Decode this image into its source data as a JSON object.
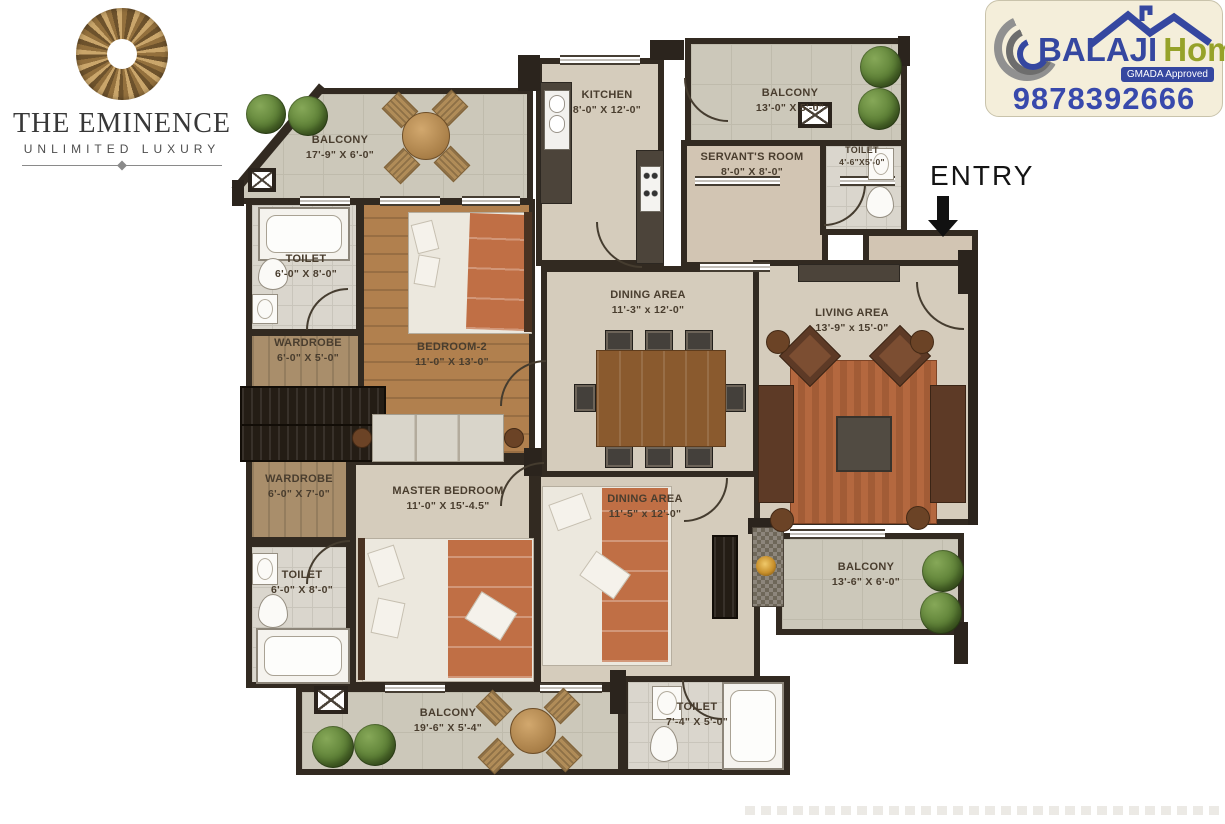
{
  "branding": {
    "title": "THE EMINENCE",
    "subtitle": "UNLIMITED LUXURY",
    "agency": {
      "name_primary": "BALAJI",
      "name_secondary": "Homes",
      "approval_badge": "GMADA Approved",
      "phone": "9878392666",
      "primary_color": "#3547a0",
      "secondary_color": "#96a229"
    }
  },
  "entry": {
    "label": "ENTRY"
  },
  "rooms": [
    {
      "id": "balcony-top-left",
      "name": "BALCONY",
      "dims": "17'-9\" X 6'-0\""
    },
    {
      "id": "toilet-top-left",
      "name": "TOILET",
      "dims": "6'-0\" X 8'-0\""
    },
    {
      "id": "wardrobe-upper",
      "name": "WARDROBE",
      "dims": "6'-0\" X 5'-0\""
    },
    {
      "id": "bedroom-2",
      "name": "BEDROOM-2",
      "dims": "11'-0\" X 13'-0\""
    },
    {
      "id": "kitchen",
      "name": "KITCHEN",
      "dims": "8'-0\" X 12'-0\""
    },
    {
      "id": "balcony-top-right",
      "name": "BALCONY",
      "dims": "13'-0\" X 5'-0\""
    },
    {
      "id": "servants-room",
      "name": "SERVANT'S ROOM",
      "dims": "8'-0\" X 8'-0\""
    },
    {
      "id": "toilet-top-right",
      "name": "TOILET",
      "dims": "4'-6\"X5'-0\""
    },
    {
      "id": "dining-area-upper",
      "name": "DINING AREA",
      "dims": "11'-3\" x 12'-0\""
    },
    {
      "id": "living-area",
      "name": "LIVING AREA",
      "dims": "13'-9\" x 15'-0\""
    },
    {
      "id": "wardrobe-lower",
      "name": "WARDROBE",
      "dims": "6'-0\" X 7'-0\""
    },
    {
      "id": "master-bedroom",
      "name": "MASTER BEDROOM",
      "dims": "11'-0\" X 15'-4.5\""
    },
    {
      "id": "toilet-lower-left",
      "name": "TOILET",
      "dims": "6'-0\" X 8'-0\""
    },
    {
      "id": "dining-area-lower",
      "name": "DINING AREA",
      "dims": "11'-5\" x 12'-0\""
    },
    {
      "id": "balcony-right",
      "name": "BALCONY",
      "dims": "13'-6\" X 6'-0\""
    },
    {
      "id": "balcony-bottom",
      "name": "BALCONY",
      "dims": "19'-6\" X 5'-4\""
    },
    {
      "id": "toilet-bottom",
      "name": "TOILET",
      "dims": "7'-4\" X 5'-0\""
    }
  ],
  "palette": {
    "wall": "#322a21",
    "floor": "#d5ccbc",
    "balcony_floor": "#ccc8ba",
    "wood_floor": "#b1804e",
    "terracotta": "#c06f45",
    "bush_green": "#5c7f35",
    "gold": "#caa66b"
  }
}
